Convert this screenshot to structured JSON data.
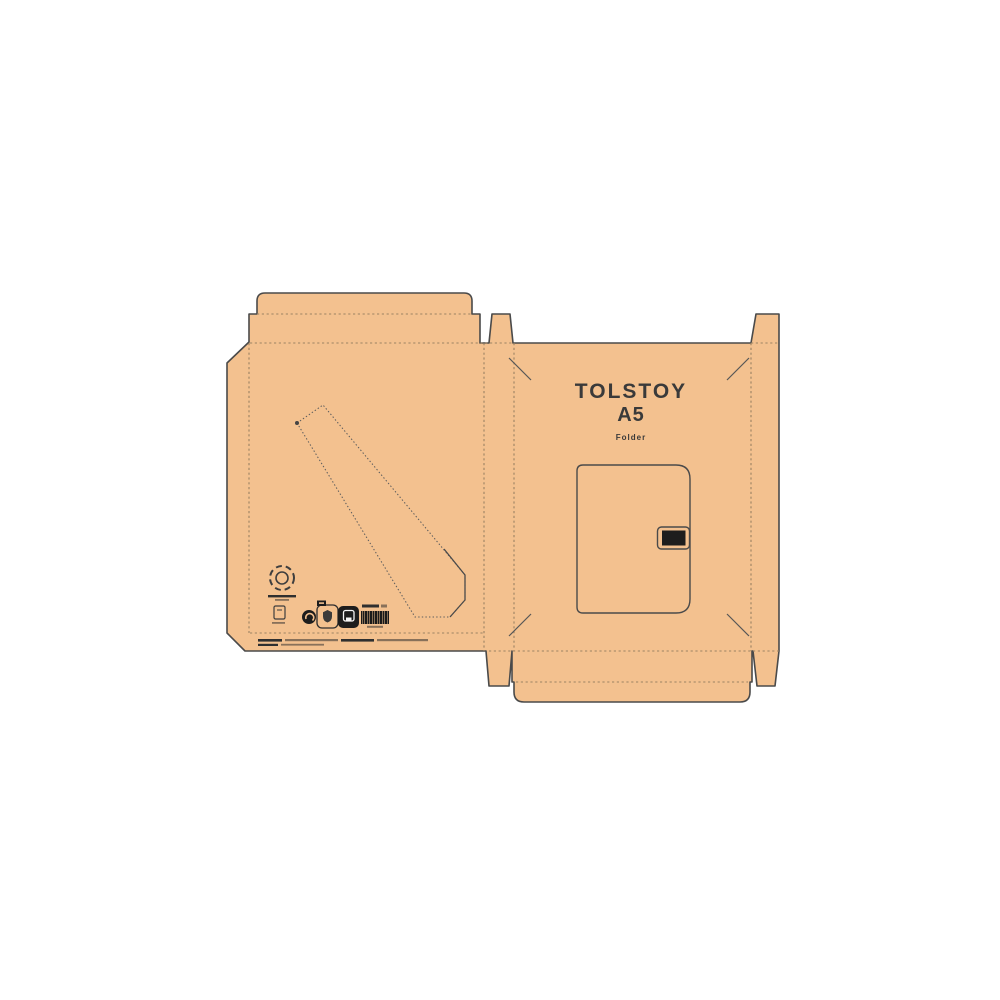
{
  "artwork": {
    "brand": "TOLSTOY",
    "size": "A5",
    "product": "Folder",
    "kind": "packaging dieline with two panels, top lid, bottom lid, glue tabs and a diagonal perforated pocket"
  },
  "colors": {
    "background": "#ffffff",
    "kraft": "#f3c18f",
    "cut_line": "#4a4a4a",
    "fold_line": "#9b8263",
    "perf_line": "#5d5d5d",
    "ink": "#3a3a3a",
    "black": "#1d1d1d"
  },
  "symbols": [
    {
      "name": "recycling-loop-icon"
    },
    {
      "name": "paper-note-icon"
    },
    {
      "name": "green-dot-icon"
    },
    {
      "name": "certification-badge-icon"
    },
    {
      "name": "material-code-chip"
    },
    {
      "name": "disposal-box-icon"
    },
    {
      "name": "barcode"
    }
  ],
  "microtext": {
    "legible": false,
    "lines": 6
  }
}
